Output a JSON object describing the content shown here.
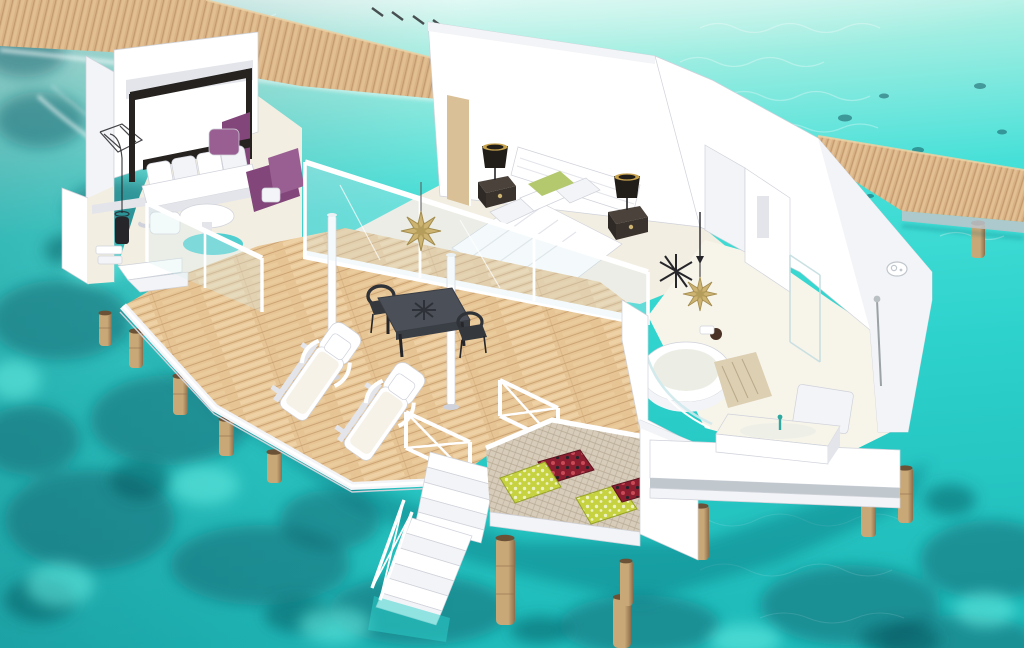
{
  "meta": {
    "description": "3D cutaway rendering of an overwater villa above a turquoise coral lagoon",
    "render_type": "isometric architectural visualization",
    "visible_text": "none"
  },
  "palette": {
    "water_pale": "#eefbf7",
    "water_light": "#a9efe3",
    "water_bright": "#46e0d8",
    "water_mid": "#2ed2cc",
    "water_deep": "#1fbcbb",
    "reef_dark": "#14626d",
    "reef_darker": "#0e4a55",
    "sand_flash": "#66efe4",
    "glare": "#ffffff",
    "wood_base": "#d8b184",
    "wood_line": "#aa8157",
    "wood_light": "#ecd0a2",
    "deck_base": "#e6c494",
    "deck_line": "#c59c6c",
    "deck_light": "#f4dcb2",
    "white": "#ffffff",
    "white_soft": "#f3f4f7",
    "white_shade": "#e3e5ea",
    "white_dim": "#cfd2da",
    "fascia_grey": "#c0c7cd",
    "floor_cream": "#f3eee2",
    "floor_bath": "#f7f4ea",
    "glass": "#d9eef0",
    "gold": "#cdb372",
    "gold_dark": "#a38c4d",
    "black": "#26262a",
    "charcoal": "#3c4046",
    "table_top": "#4b4f57",
    "purple": "#82467b",
    "purple_light": "#9a5f92",
    "teal_rug": "#3fcbce",
    "green_pillow": "#b4c96e",
    "lime": "#c6d23f",
    "lime_pale": "#eef2c3",
    "red_dark": "#8b1f30",
    "red_light": "#c94b57",
    "net": "#d7ccba",
    "net_line": "#b4a791",
    "pile": "#c8a877",
    "pile_dark": "#8d6e4b",
    "pile_top": "#6b5236",
    "shadow_water": "#0d5a66",
    "lamp_shade": "#211d19",
    "lamp_glow": "#c9a44f",
    "canopy": "#262220",
    "door_wood": "#d9c096",
    "rug_beige": "#dccfb2"
  },
  "scene": {
    "environment": [
      "turquoise-lagoon-with-coral-reef-patches",
      "sun-glare-on-water-top",
      "wooden-walkway-top-left",
      "wooden-walkway-right",
      "timber-support-piles",
      "white-foam-wake-left"
    ],
    "rooms": [
      {
        "name": "living-lounge",
        "items": [
          "canopy-daybed-dark-frame",
          "white-back-cushions x4",
          "purple-armchair",
          "purple-cushion",
          "round-white-coffee-table",
          "teal-round-rug",
          "white-ottoman",
          "sketch-floor-lamp",
          "balcony-nook-with-planter-and-bin"
        ]
      },
      {
        "name": "bedroom",
        "items": [
          "double-bed-white",
          "white-headboard",
          "pillows-white x3",
          "green-accent-pillow",
          "nightstand-dark x2",
          "black-table-lamp-gold-rim x2",
          "tan-wood-door-panel"
        ]
      },
      {
        "name": "hall",
        "items": [
          "black-pendant-lamp",
          "gold-star-ornament",
          "black-starfish-ornament"
        ]
      },
      {
        "name": "bathroom",
        "items": [
          "round-soaking-tub",
          "curved-glass-screen",
          "beige-bath-rug",
          "dark-toiletry-bag",
          "wall-rain-shower-head",
          "hand-shower-rail",
          "deck-bathtub-with-teal-faucet",
          "glass-shower-panels"
        ]
      },
      {
        "name": "sun-deck",
        "items": [
          "diagonal-timber-decking",
          "sun-lounger-white x2",
          "lounger-pillow x2",
          "dark-dining-table-star-motif",
          "black-wicker-chair x2",
          "white-shade-pole x2",
          "glass-railing-white-frame",
          "gold-star-ornament",
          "x-brace-railing-panels"
        ]
      },
      {
        "name": "net-daybed-deck",
        "items": [
          "woven-net-platform",
          "lime-patterned-pillow x2",
          "red-ikat-pillow x2",
          "white-privacy-wall"
        ]
      },
      {
        "name": "stairs",
        "items": [
          "upper-white-stairs",
          "lower-white-stairs-into-water",
          "x-brace-stair-railing"
        ]
      }
    ],
    "counts": {
      "sun_loungers": 2,
      "dining_chairs": 2,
      "net_pillows": 4,
      "gold_stars": 2,
      "table_lamps": 2,
      "walkways": 2
    }
  }
}
